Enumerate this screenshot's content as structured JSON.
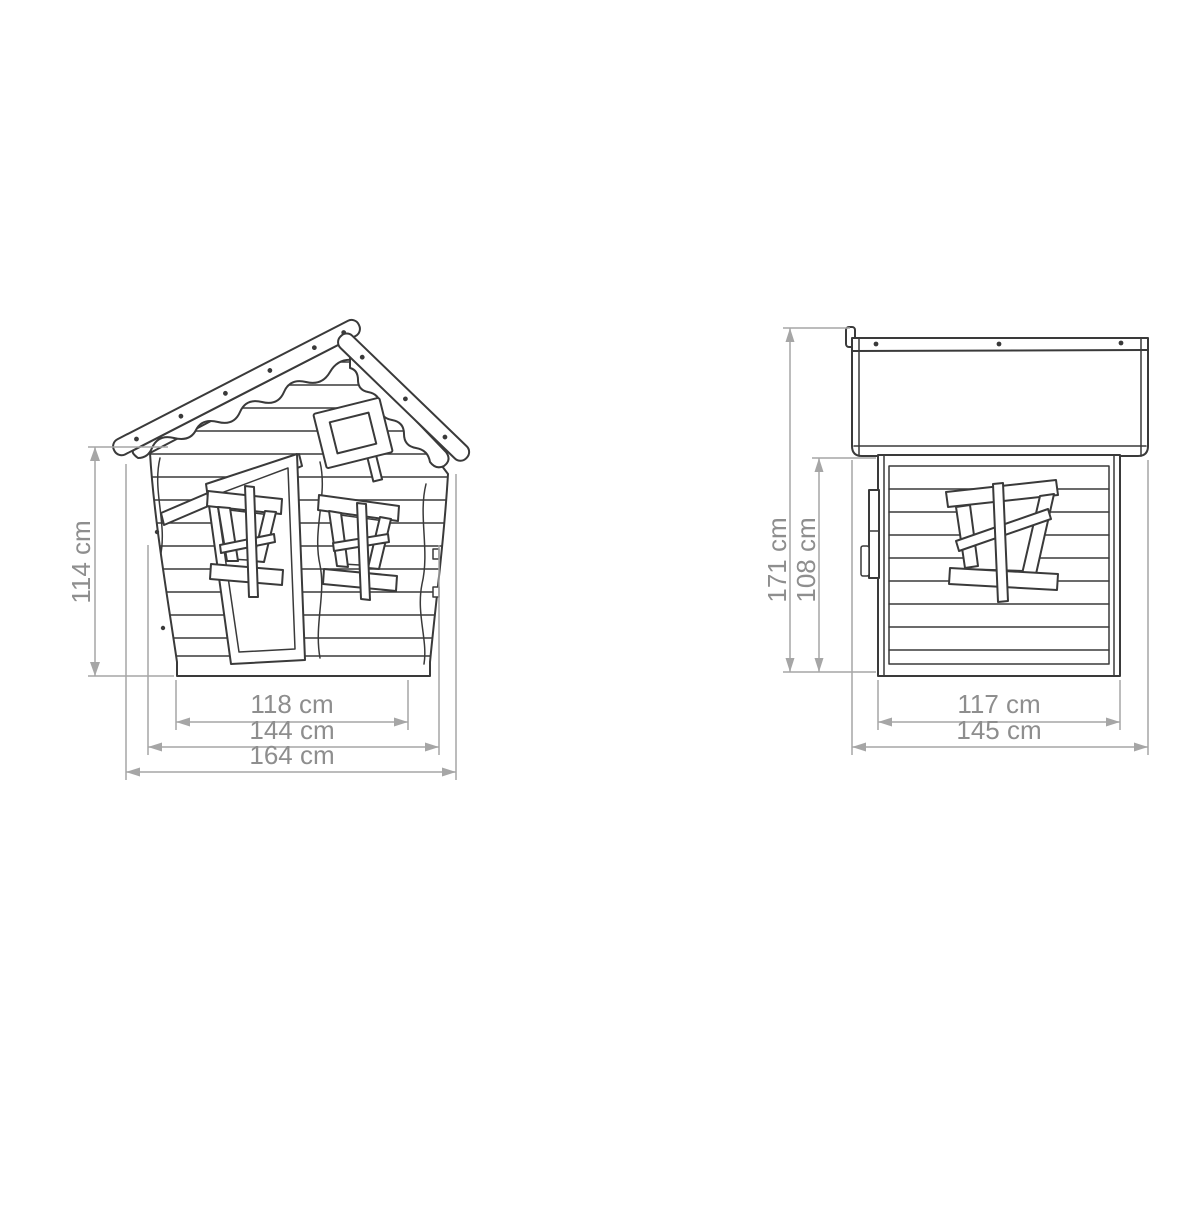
{
  "colors": {
    "outline": "#3a3a3a",
    "dimension_line": "#a6a6a6",
    "dimension_text": "#8e8e8e",
    "background": "#ffffff"
  },
  "front_view": {
    "dimensions": {
      "height": "114 cm",
      "base_width": "118 cm",
      "wall_width": "144 cm",
      "overall_width": "164 cm"
    }
  },
  "side_view": {
    "dimensions": {
      "overall_height": "171 cm",
      "wall_height": "108 cm",
      "wall_depth": "117 cm",
      "roof_depth": "145 cm"
    }
  }
}
